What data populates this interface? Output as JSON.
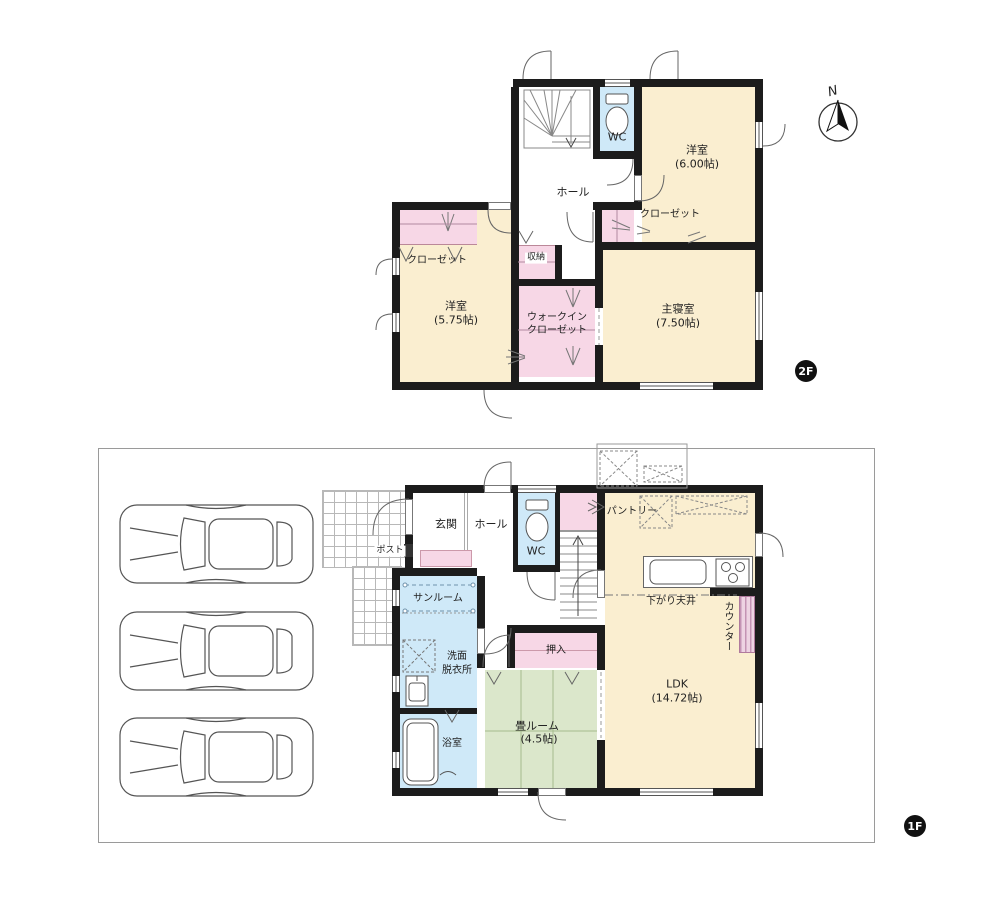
{
  "compass": {
    "north": "N"
  },
  "f2": {
    "badge": "2F",
    "wc": "WC",
    "hall": "ホール",
    "yoshitsu6": {
      "name": "洋室",
      "area": "(6.00帖)"
    },
    "closet6": "クローゼット",
    "closet575": "クローゼット",
    "yoshitsu575": {
      "name": "洋室",
      "area": "(5.75帖)"
    },
    "shuno": "収納",
    "wic": {
      "line1": "ウォークイン",
      "line2": "クローゼット"
    },
    "shushinshitsu": {
      "name": "主寝室",
      "area": "(7.50帖)"
    }
  },
  "f1": {
    "badge": "1F",
    "genkan": "玄関",
    "hall": "ホール",
    "wc": "WC",
    "pantry": "パントリー",
    "post": "ポスト",
    "sunroom": "サンルーム",
    "senmen": {
      "line1": "洗面",
      "line2": "脱衣所"
    },
    "bath": "浴室",
    "oshiire": "押入",
    "tatami": {
      "name": "畳ルーム",
      "area": "(4.5帖)"
    },
    "sagari_tenjo": "下がり天井",
    "counter": "カウンター",
    "ldk": {
      "name": "LDK",
      "area": "(14.72帖)"
    }
  },
  "colors": {
    "room_cream": "#faeed0",
    "closet_pink": "#f7d7e6",
    "water_blue": "#cfe9f8",
    "tatami_green": "#dbe7cb",
    "wall": "#1c1c1c"
  }
}
